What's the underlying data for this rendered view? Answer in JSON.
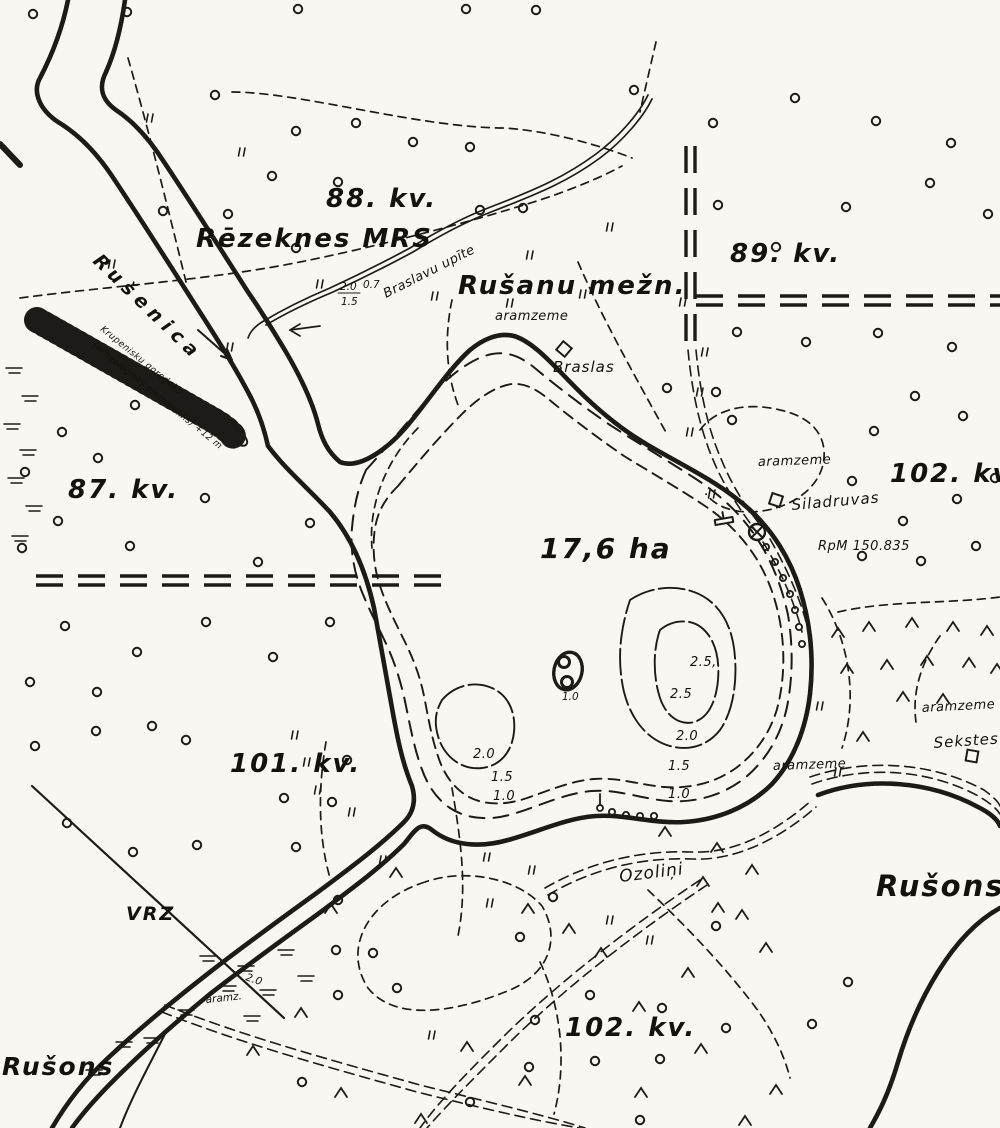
{
  "colors": {
    "ink": "#1d1b17",
    "paper": "#f9f7f2"
  },
  "labels": {
    "river_name": "Rušenica",
    "mound_line1": "Krupenisku gorodoks",
    "mound_line2": "(arheoloģisks piemineklis) +12 m",
    "kv_88": "88. kv.",
    "rezeknes_mrs": "Rēzeknes MRS",
    "stream_name": "Braslavu upīte",
    "stream_width": "2.0",
    "stream_depth": "1.5",
    "stream_speed": "0.7",
    "rusanu_mezn": "Rušanu mežn.",
    "kv_89": "89. kv.",
    "aramzeme_north": "aramzeme",
    "braslas": "Braslas",
    "kv_87": "87. kv.",
    "kv_102_east": "102. kv.",
    "aramzeme_east": "aramzeme",
    "siladruvas": "Siladruvas",
    "benchmark": "RpM  150.835",
    "lake_area": "17,6 ha",
    "island_depth": "1.0",
    "depth_east": [
      "2.5,",
      "2.5",
      "2.0",
      "1.5",
      "1.0"
    ],
    "depth_west": [
      "2.0",
      "1.5",
      "1.0"
    ],
    "kv_101": "101. kv.",
    "vrz": "VRZ",
    "aramzeme_southeast": "aramzeme",
    "aramzeme_far_east": "aramzeme",
    "sekstes": "Sekstes",
    "rusons_east": "Rušons",
    "ozolini": "Ozoliņi",
    "aramz_abbr": "aramz.",
    "marsh_depth": "2.0",
    "kv_102_south": "102. kv.",
    "rusons_west": "Rušons"
  },
  "symbols": {
    "deciduous_tree": "small open circle",
    "conifer": "open chevron",
    "meadow": "double tick",
    "marsh": "short parallel dashes",
    "building": "small square",
    "benchmark_point": "circle with cross",
    "dock": "T-shaped pier",
    "flow_arrow": "arrow along watercourse",
    "burial_mound": "hatched ridge strip",
    "quarter_boundary": "double dashed heavy line",
    "road": "double dashed thin line",
    "trail": "single dashed line",
    "depth_contour": "dashed closed curve"
  }
}
